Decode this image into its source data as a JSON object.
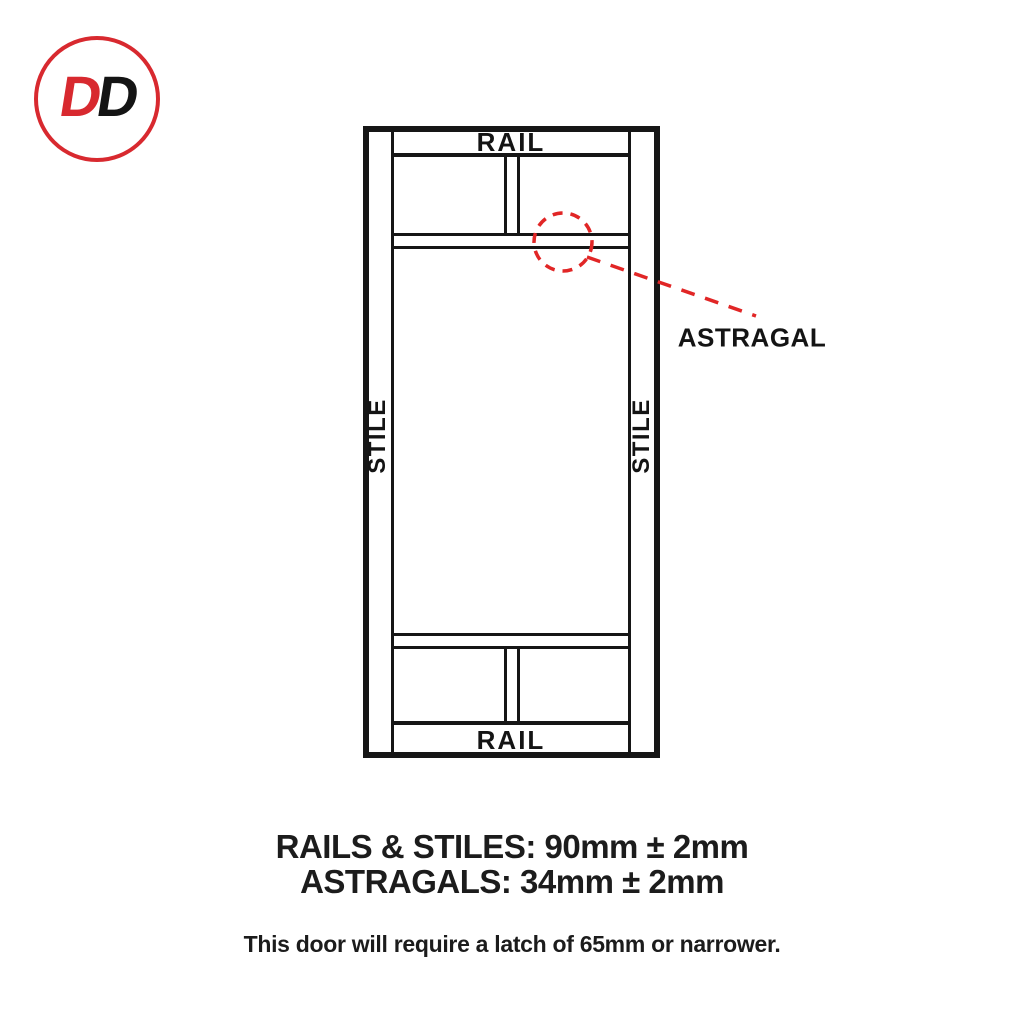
{
  "logo": {
    "letters": {
      "first": "D",
      "second": "D"
    }
  },
  "diagram": {
    "labels": {
      "rail_top": "RAIL",
      "rail_bottom": "RAIL",
      "stile_left": "STILE",
      "stile_right": "STILE",
      "astragal": "ASTRAGAL"
    }
  },
  "specs": {
    "rails_stiles": "RAILS & STILES: 90mm ± 2mm",
    "astragals": "ASTRAGALS: 34mm ± 2mm",
    "latch_note": "This door will require a latch of 65mm or narrower."
  },
  "colors": {
    "brand_red": "#d8292f",
    "annotation_red": "#e12626",
    "line_black": "#161616"
  }
}
